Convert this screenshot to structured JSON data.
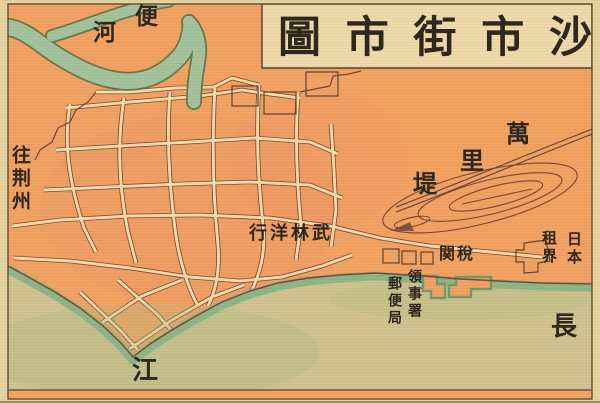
{
  "map": {
    "title": {
      "text": "沙市街市圖",
      "reading_direction": "right-to-left",
      "chars_rtl": [
        "圖",
        "市",
        "街",
        "市",
        "沙"
      ]
    },
    "labels": {
      "bianhe": {
        "text": "便河",
        "chars": [
          "便",
          "河"
        ]
      },
      "to_jingzhou": {
        "text": "往荆州"
      },
      "wulin_yanghang": {
        "text": "武林洋行",
        "display_rtl": "行洋林武"
      },
      "wanlidi": {
        "text": "萬里堤",
        "chars": [
          "萬",
          "里",
          "堤"
        ]
      },
      "customs": {
        "text": "稅関",
        "display_rtl": "関稅"
      },
      "japan": {
        "text": "日本"
      },
      "concession": {
        "text": "租界"
      },
      "consulate": {
        "text": "領事署"
      },
      "post_office": {
        "text": "郵便局"
      },
      "yangtze": {
        "text": "長江",
        "chars": [
          "長",
          "江"
        ]
      }
    },
    "colors": {
      "land": "#f2a161",
      "street": "#f3dcab",
      "street_outline": "#82452f",
      "canal_green": "#a2c29b",
      "canal_outline": "#667549",
      "river_tan": "#cfc28f",
      "shore_green": "#8cb585",
      "ink": "#2b241a",
      "title_box": "#eed9a8",
      "border": "#554330",
      "page": "#e6d2a0"
    }
  }
}
